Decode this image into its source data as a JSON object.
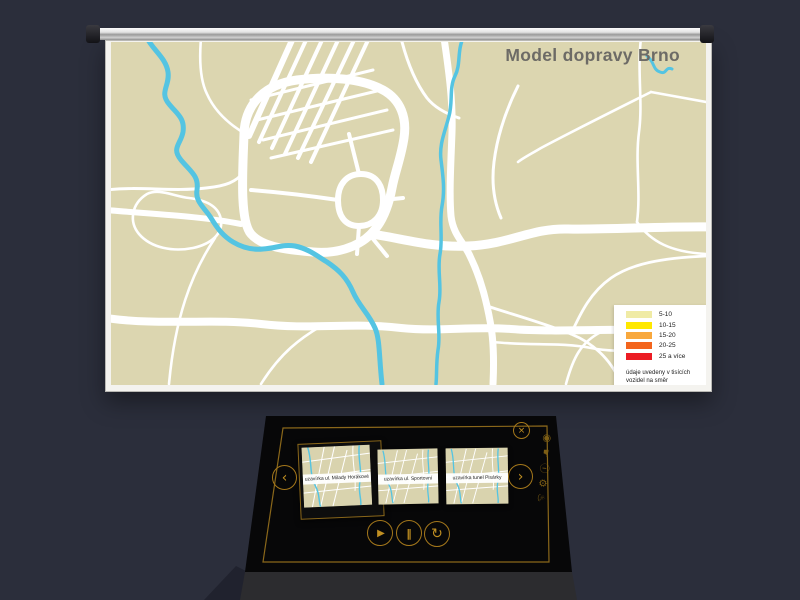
{
  "scene": {
    "background_color": "#2b2e3b"
  },
  "screen": {
    "title": "Model dopravy Brno",
    "colors": {
      "map_background": "#dcd6b0",
      "river": "#54c4e2",
      "road": "#ffffff",
      "title_text": "#6d6b66"
    },
    "legend": {
      "items": [
        {
          "label": "5-10",
          "color": "#f0eba5"
        },
        {
          "label": "10-15",
          "color": "#ffe800"
        },
        {
          "label": "15-20",
          "color": "#f8a83d"
        },
        {
          "label": "20-25",
          "color": "#f3651d"
        },
        {
          "label": "25 a více",
          "color": "#ec1c24"
        }
      ],
      "note": "údaje uvedeny v tisících vozidel na směr"
    }
  },
  "console": {
    "colors": {
      "body": "#070708",
      "front": "#2c2c2f",
      "accent_gold": "#a5781b"
    },
    "thumbnails": [
      {
        "caption": "uzavírka ul. Milady Horákové",
        "selected": true
      },
      {
        "caption": "uzavírka ul. Sportovní",
        "selected": false
      },
      {
        "caption": "uzavírka tunel Pisárky",
        "selected": false
      }
    ],
    "buttons": {
      "prev": "‹",
      "next": "›",
      "close": "×",
      "play": "▶",
      "pause": "‖",
      "replay": "↻"
    },
    "side_icons": [
      {
        "name": "dial-icon",
        "glyph": "◉"
      },
      {
        "name": "hand-pointer-icon",
        "glyph": "☛"
      },
      {
        "name": "info-icon",
        "glyph": "ⓘ"
      },
      {
        "name": "gear-icon",
        "glyph": "⚙"
      },
      {
        "name": "lamp-icon",
        "glyph": "♨"
      }
    ]
  }
}
